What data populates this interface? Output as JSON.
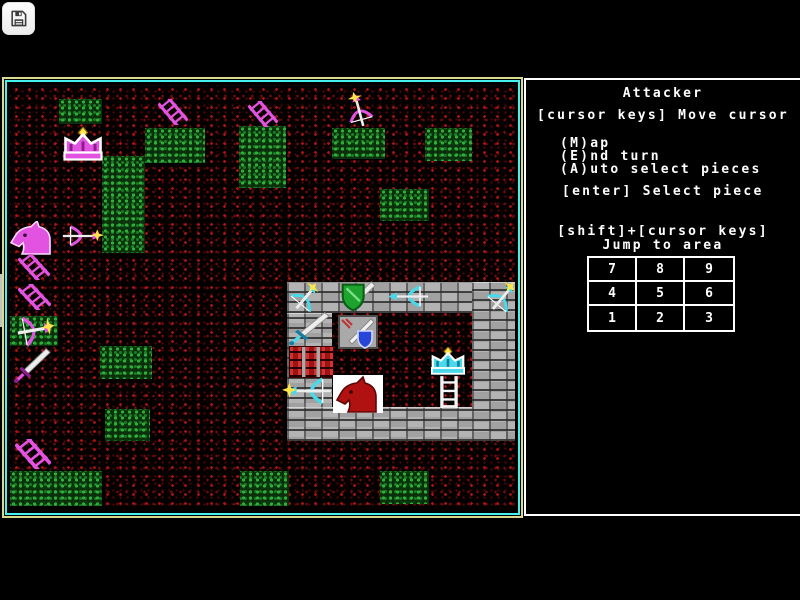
{
  "toolbar": {
    "save_button": {
      "icon": "floppy-disk-icon"
    }
  },
  "side_tab": {
    "icon": "chevron-right-icon",
    "chevron": "›"
  },
  "game": {
    "turn_label": "Attacker",
    "instructions": {
      "move": "[cursor keys] Move cursor",
      "menu": [
        "(M)ap",
        "(E)nd turn",
        "(A)uto select pieces"
      ],
      "select": "[enter] Select piece",
      "jump_combo": "[shift]+[cursor keys]",
      "jump_label": "Jump to area"
    },
    "jump_grid": {
      "rows": [
        [
          "7",
          "8",
          "9"
        ],
        [
          "4",
          "5",
          "6"
        ],
        [
          "1",
          "2",
          "3"
        ]
      ]
    }
  },
  "map": {
    "colors": {
      "attacker": "#e253e2",
      "attacker_dark": "#8d1d8d",
      "defender": "#49d9e8",
      "defender_dark": "#157ea0",
      "star": "#ffe44a",
      "blade": "#ededed",
      "wall": "#b3b3b3",
      "rubble": "#b41414",
      "terrain_green": "#2fae3a",
      "ground_red": "#a81414",
      "border_outer": "#d9d98f",
      "border_inner": "#44f0f0",
      "cursor_tile": "#ffffff",
      "cursor_horse": "#b01212",
      "panel_border": "#ffffff",
      "panel_text": "#ffffff"
    },
    "terrain_patches": [
      {
        "x": 49,
        "y": 14,
        "w": 43,
        "h": 25
      },
      {
        "x": 135,
        "y": 43,
        "w": 60,
        "h": 35
      },
      {
        "x": 229,
        "y": 41,
        "w": 47,
        "h": 62
      },
      {
        "x": 92,
        "y": 71,
        "w": 43,
        "h": 97
      },
      {
        "x": 322,
        "y": 43,
        "w": 53,
        "h": 31
      },
      {
        "x": 415,
        "y": 43,
        "w": 47,
        "h": 33
      },
      {
        "x": 370,
        "y": 104,
        "w": 49,
        "h": 32
      },
      {
        "x": 0,
        "y": 231,
        "w": 48,
        "h": 30
      },
      {
        "x": 90,
        "y": 261,
        "w": 52,
        "h": 33
      },
      {
        "x": 95,
        "y": 324,
        "w": 45,
        "h": 32
      },
      {
        "x": 0,
        "y": 386,
        "w": 92,
        "h": 35
      },
      {
        "x": 230,
        "y": 386,
        "w": 49,
        "h": 35
      },
      {
        "x": 370,
        "y": 386,
        "w": 49,
        "h": 33
      }
    ],
    "castle": {
      "walls": [
        {
          "x": 277,
          "y": 197,
          "w": 231,
          "h": 31,
          "name": "castle-wall-top"
        },
        {
          "x": 277,
          "y": 228,
          "w": 45,
          "h": 96,
          "name": "castle-wall-left"
        },
        {
          "x": 277,
          "y": 322,
          "w": 231,
          "h": 34,
          "name": "castle-wall-bottom"
        },
        {
          "x": 462,
          "y": 197,
          "w": 46,
          "h": 159,
          "name": "castle-wall-right"
        }
      ],
      "rubble": {
        "x": 279,
        "y": 261,
        "w": 43,
        "h": 30,
        "name": "castle-wall-rubble"
      }
    },
    "pieces": [
      {
        "type": "crown",
        "side": "attacker",
        "x": 50,
        "y": 42,
        "w": 46,
        "h": 34,
        "rot": 0,
        "name": "attacker-king-crown"
      },
      {
        "type": "ladder",
        "side": "attacker",
        "x": 148,
        "y": 14,
        "w": 30,
        "h": 26,
        "rot": 0,
        "name": "attacker-ladder"
      },
      {
        "type": "ladder",
        "side": "attacker",
        "x": 238,
        "y": 16,
        "w": 30,
        "h": 26,
        "rot": 0,
        "name": "attacker-ladder"
      },
      {
        "type": "bow_star",
        "side": "attacker",
        "x": 330,
        "y": 12,
        "w": 38,
        "h": 26,
        "rot": -105,
        "name": "attacker-archer"
      },
      {
        "type": "horse",
        "side": "attacker",
        "x": 0,
        "y": 136,
        "w": 46,
        "h": 34,
        "rot": 0,
        "name": "attacker-knight"
      },
      {
        "type": "bow_star",
        "side": "attacker",
        "x": 50,
        "y": 140,
        "w": 44,
        "h": 22,
        "rot": 0,
        "name": "attacker-archer"
      },
      {
        "type": "ladder",
        "side": "attacker",
        "x": 8,
        "y": 169,
        "w": 32,
        "h": 26,
        "rot": 0,
        "name": "attacker-ladder"
      },
      {
        "type": "ladder",
        "side": "attacker",
        "x": 8,
        "y": 199,
        "w": 33,
        "h": 26,
        "rot": 0,
        "name": "attacker-ladder"
      },
      {
        "type": "bow_star",
        "side": "attacker",
        "x": 5,
        "y": 229,
        "w": 40,
        "h": 32,
        "rot": -10,
        "name": "attacker-archer"
      },
      {
        "type": "sword",
        "side": "attacker",
        "x": 2,
        "y": 262,
        "w": 40,
        "h": 38,
        "rot": 0,
        "name": "attacker-swordsman"
      },
      {
        "type": "ladder",
        "side": "attacker",
        "x": 5,
        "y": 354,
        "w": 36,
        "h": 30,
        "rot": 0,
        "name": "attacker-ladder"
      },
      {
        "type": "bow_star",
        "side": "defender",
        "x": 279,
        "y": 198,
        "w": 34,
        "h": 28,
        "rot": -50,
        "name": "defender-archer"
      },
      {
        "type": "shield_sword",
        "side": "defender",
        "x": 327,
        "y": 196,
        "w": 40,
        "h": 33,
        "rot": 0,
        "name": "defender-shield-guard"
      },
      {
        "type": "bow_left",
        "side": "defender",
        "x": 375,
        "y": 200,
        "w": 46,
        "h": 23,
        "rot": 0,
        "name": "defender-archer"
      },
      {
        "type": "bow_star",
        "side": "defender",
        "x": 475,
        "y": 198,
        "w": 36,
        "h": 28,
        "rot": -50,
        "name": "defender-archer"
      },
      {
        "type": "sword",
        "side": "defender",
        "x": 277,
        "y": 226,
        "w": 44,
        "h": 36,
        "rot": 0,
        "name": "defender-swordsman"
      },
      {
        "type": "armory",
        "side": "defender",
        "x": 328,
        "y": 230,
        "w": 40,
        "h": 34,
        "rot": 0,
        "name": "defender-armory-tile"
      },
      {
        "type": "bow_left_star",
        "side": "defender",
        "x": 272,
        "y": 292,
        "w": 52,
        "h": 28,
        "rot": 0,
        "name": "defender-archer"
      },
      {
        "type": "horse_cursor",
        "side": "defender",
        "x": 323,
        "y": 290,
        "w": 50,
        "h": 38,
        "rot": 0,
        "name": "cursor-selected-knight"
      },
      {
        "type": "crown",
        "side": "defender",
        "x": 418,
        "y": 262,
        "w": 40,
        "h": 28,
        "rot": 0,
        "name": "defender-king-crown"
      },
      {
        "type": "ladder_vert",
        "side": "defender",
        "x": 426,
        "y": 290,
        "w": 26,
        "h": 34,
        "rot": 0,
        "name": "defender-ladder"
      }
    ]
  }
}
